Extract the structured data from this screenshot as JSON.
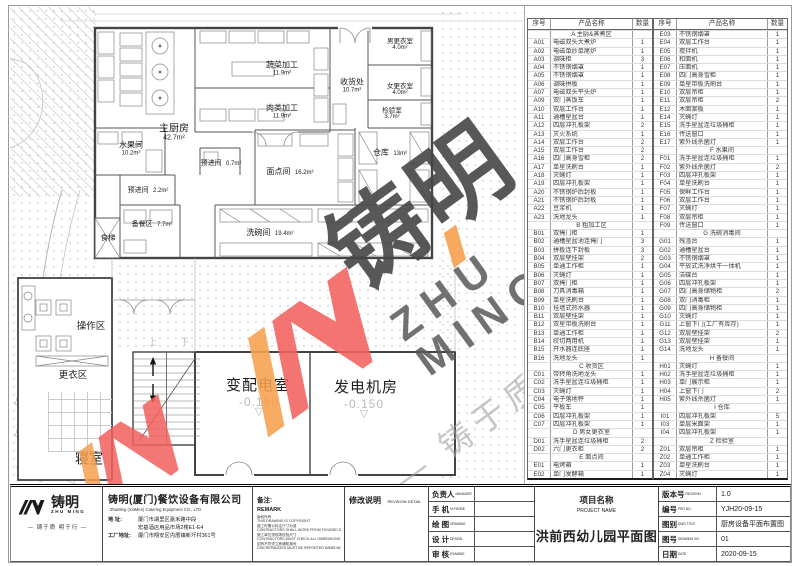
{
  "brand_colors": {
    "coral": "#f2615e",
    "orange": "#f6a04e",
    "logo_black": "#1a1a1a"
  },
  "watermark": {
    "brand": "铸明",
    "brand_en": "ZHU MING",
    "tagline": "— 铸于质 明于行 —"
  },
  "plan": {
    "stair_up": "上",
    "stair_down": "下",
    "levels": [
      {
        "value": "-0.150"
      },
      {
        "value": "-0.150"
      }
    ],
    "rooms": [
      {
        "name": "蔬菜加工",
        "area": "11.9m²"
      },
      {
        "name": "肉类加工",
        "area": "11.9m²"
      },
      {
        "name": "收货处",
        "area": "10.7m²"
      },
      {
        "name": "男更衣室",
        "area": "4.0m²"
      },
      {
        "name": "女更衣室",
        "area": "4.0m²"
      },
      {
        "name": "检验室",
        "area": "3.7m²"
      },
      {
        "name": "主厨房",
        "area": "42.7m²"
      },
      {
        "name": "水果间",
        "area": "10.2m²"
      },
      {
        "name": "预进间",
        "area": "2.2m²"
      },
      {
        "name": "预进间",
        "area": "0.7m²"
      },
      {
        "name": "面点间",
        "area": "16.2m²"
      },
      {
        "name": "仓库",
        "area": "13m²"
      },
      {
        "name": "备餐区",
        "area": "7.7m²"
      },
      {
        "name": "洗碗间",
        "area": "19.4m²"
      },
      {
        "name": "食梯",
        "area": ""
      },
      {
        "name": "操作区",
        "area": ""
      },
      {
        "name": "更衣区",
        "area": ""
      },
      {
        "name": "寝室",
        "area": ""
      },
      {
        "name": "变配电室",
        "area": ""
      },
      {
        "name": "发电机房",
        "area": ""
      }
    ]
  },
  "tables": {
    "headers": [
      "序号",
      "产品名称",
      "数量"
    ],
    "left": {
      "rows": [
        {
          "section": true,
          "code": "",
          "name": "A 主厨&蒸煮区",
          "qty": ""
        },
        {
          "code": "A01",
          "name": "电磁双头大煮炉",
          "qty": "1"
        },
        {
          "code": "A02",
          "name": "电磁单炒单尾炉",
          "qty": "1"
        },
        {
          "code": "A03",
          "name": "调味柜",
          "qty": "3"
        },
        {
          "code": "A04",
          "name": "不锈钢烟罩",
          "qty": "1"
        },
        {
          "code": "A05",
          "name": "不锈钢烟罩",
          "qty": "1"
        },
        {
          "code": "A06",
          "name": "调味拼板",
          "qty": "1"
        },
        {
          "code": "A07",
          "name": "电磁双头平头炉",
          "qty": "1"
        },
        {
          "code": "A09",
          "name": "双门蒸饭车",
          "qty": "1"
        },
        {
          "code": "A10",
          "name": "双层工作台",
          "qty": "1"
        },
        {
          "code": "A11",
          "name": "通槽星盆台",
          "qty": "1"
        },
        {
          "code": "A12",
          "name": "四层冲孔板架",
          "qty": "2"
        },
        {
          "code": "A13",
          "name": "灭火系统",
          "qty": "1"
        },
        {
          "code": "A14",
          "name": "双层工作台",
          "qty": "2"
        },
        {
          "code": "A15",
          "name": "双层工作台",
          "qty": "2"
        },
        {
          "code": "A16",
          "name": "四门高身雪柜",
          "qty": "2"
        },
        {
          "code": "A17",
          "name": "单星洗刷台",
          "qty": "1"
        },
        {
          "code": "A18",
          "name": "灭蝇灯",
          "qty": "1"
        },
        {
          "code": "A19",
          "name": "四层冲孔板架",
          "qty": "1"
        },
        {
          "code": "A20",
          "name": "不锈钢炉后封板",
          "qty": "1"
        },
        {
          "code": "A21",
          "name": "不锈钢炉后封板",
          "qty": "1"
        },
        {
          "code": "A22",
          "name": "豆浆机",
          "qty": "1"
        },
        {
          "code": "A23",
          "name": "洗地龙头",
          "qty": "1"
        },
        {
          "section": true,
          "code": "",
          "name": "B 粗加工区",
          "qty": ""
        },
        {
          "code": "B01",
          "name": "双掩门柜",
          "qty": "1"
        },
        {
          "code": "B02",
          "name": "通槽星盆池连掩门",
          "qty": "3"
        },
        {
          "code": "B03",
          "name": "拼板连下封板",
          "qty": "3"
        },
        {
          "code": "B04",
          "name": "双层壁挂架",
          "qty": "2"
        },
        {
          "code": "B05",
          "name": "单通工作柜",
          "qty": "1"
        },
        {
          "code": "B06",
          "name": "灭蝇灯",
          "qty": "1"
        },
        {
          "code": "B07",
          "name": "双掩门柜",
          "qty": "1"
        },
        {
          "code": "B08",
          "name": "刀具消毒箱",
          "qty": "1"
        },
        {
          "code": "B09",
          "name": "单星洗刷台",
          "qty": "1"
        },
        {
          "code": "B10",
          "name": "挂墙式热水器",
          "qty": "1"
        },
        {
          "code": "B11",
          "name": "双层壁挂架",
          "qty": "1"
        },
        {
          "code": "B12",
          "name": "双星带板洗刷台",
          "qty": "1"
        },
        {
          "code": "B13",
          "name": "单通工作柜",
          "qty": "1"
        },
        {
          "code": "B14",
          "name": "绞切两用机",
          "qty": "1"
        },
        {
          "code": "B15",
          "name": "开水器连底座",
          "qty": "1"
        },
        {
          "code": "B16",
          "name": "洗地龙头",
          "qty": "1"
        },
        {
          "section": true,
          "code": "",
          "name": "C 收货区",
          "qty": ""
        },
        {
          "code": "C01",
          "name": "带转角洗地龙头",
          "qty": "1"
        },
        {
          "code": "C02",
          "name": "洗手星盆连垃圾桶柜",
          "qty": "1"
        },
        {
          "code": "C03",
          "name": "灭蝇灯",
          "qty": "1"
        },
        {
          "code": "C04",
          "name": "电子落地秤",
          "qty": "1"
        },
        {
          "code": "C05",
          "name": "平板车",
          "qty": "1"
        },
        {
          "code": "C06",
          "name": "四层冲孔板架",
          "qty": "1"
        },
        {
          "code": "C07",
          "name": "四层冲孔板架",
          "qty": "1"
        },
        {
          "section": true,
          "code": "",
          "name": "D 男女更衣室",
          "qty": ""
        },
        {
          "code": "D01",
          "name": "洗手星盆连垃圾桶柜",
          "qty": "2"
        },
        {
          "code": "D02",
          "name": "六门更衣柜",
          "qty": "2"
        },
        {
          "section": true,
          "code": "",
          "name": "E 面点间",
          "qty": ""
        },
        {
          "code": "E01",
          "name": "电烤箱",
          "qty": "1"
        },
        {
          "code": "E02",
          "name": "单门发酵箱",
          "qty": "1"
        }
      ]
    },
    "right": {
      "rows": [
        {
          "code": "E03",
          "name": "不锈钢烟罩",
          "qty": "1"
        },
        {
          "code": "E04",
          "name": "双层工作台",
          "qty": "1"
        },
        {
          "code": "E05",
          "name": "搅拌机",
          "qty": "1"
        },
        {
          "code": "E06",
          "name": "和面机",
          "qty": "1"
        },
        {
          "code": "E07",
          "name": "压面机",
          "qty": "1"
        },
        {
          "code": "E08",
          "name": "四门高身雪柜",
          "qty": "1"
        },
        {
          "code": "E09",
          "name": "单星带板洗刷台",
          "qty": "1"
        },
        {
          "code": "E10",
          "name": "双层吊柜",
          "qty": "1"
        },
        {
          "code": "E11",
          "name": "双层吊柜",
          "qty": "2"
        },
        {
          "code": "E12",
          "name": "木面案板",
          "qty": "1"
        },
        {
          "code": "E14",
          "name": "灭蝇灯",
          "qty": "1"
        },
        {
          "code": "E15",
          "name": "洗手星盆连垃圾桶柜",
          "qty": "1"
        },
        {
          "code": "E16",
          "name": "传送窗口",
          "qty": "1"
        },
        {
          "code": "E17",
          "name": "紫外线杀菌灯",
          "qty": "1"
        },
        {
          "section": true,
          "code": "",
          "name": "F 水果间",
          "qty": ""
        },
        {
          "code": "F01",
          "name": "洗手星盆连垃圾桶柜",
          "qty": "1"
        },
        {
          "code": "F02",
          "name": "紫外线杀菌灯",
          "qty": "2"
        },
        {
          "code": "F03",
          "name": "四层冲孔板架",
          "qty": "1"
        },
        {
          "code": "F04",
          "name": "单星洗刷台",
          "qty": "1"
        },
        {
          "code": "F05",
          "name": "保鲜工作台",
          "qty": "1"
        },
        {
          "code": "F06",
          "name": "双层工作台",
          "qty": "1"
        },
        {
          "code": "F07",
          "name": "灭蝇灯",
          "qty": "1"
        },
        {
          "code": "F08",
          "name": "双层吊柜",
          "qty": "1"
        },
        {
          "code": "F09",
          "name": "传送窗口",
          "qty": "1"
        },
        {
          "section": true,
          "code": "",
          "name": "G 洗碗消毒间",
          "qty": ""
        },
        {
          "code": "G01",
          "name": "残渣台",
          "qty": "1"
        },
        {
          "code": "G02",
          "name": "通槽星盆台",
          "qty": "1"
        },
        {
          "code": "G03",
          "name": "不锈钢烟罩",
          "qty": "1"
        },
        {
          "code": "G04",
          "name": "平放式洗净烘干一体机",
          "qty": "1"
        },
        {
          "code": "G05",
          "name": "洁碟台",
          "qty": "1"
        },
        {
          "code": "G06",
          "name": "四层冲孔板架",
          "qty": "1"
        },
        {
          "code": "G07",
          "name": "四门高身储物柜",
          "qty": "2"
        },
        {
          "code": "G08",
          "name": "双门消毒柜",
          "qty": "1"
        },
        {
          "code": "G09",
          "name": "四门高身储物柜",
          "qty": "1"
        },
        {
          "code": "G10",
          "name": "灭蝇灯",
          "qty": "1"
        },
        {
          "code": "G11",
          "name": "上窗下门(工厂有库存)",
          "qty": "1"
        },
        {
          "code": "G12",
          "name": "双层壁挂架",
          "qty": "2"
        },
        {
          "code": "G13",
          "name": "双层壁挂架",
          "qty": "1"
        },
        {
          "code": "G14",
          "name": "洗地龙头",
          "qty": "1"
        },
        {
          "section": true,
          "code": "",
          "name": "H 备餐间",
          "qty": ""
        },
        {
          "code": "H01",
          "name": "灭蝇灯",
          "qty": "1"
        },
        {
          "code": "H02",
          "name": "洗手星盆连垃圾桶柜",
          "qty": "1"
        },
        {
          "code": "H03",
          "name": "单门展示柜",
          "qty": "1"
        },
        {
          "code": "H04",
          "name": "上窗下门",
          "qty": "2"
        },
        {
          "code": "H05",
          "name": "紫外线杀菌灯",
          "qty": "1"
        },
        {
          "section": true,
          "code": "",
          "name": "I 仓库",
          "qty": ""
        },
        {
          "code": "I01",
          "name": "四层冲孔板架",
          "qty": "5"
        },
        {
          "code": "I03",
          "name": "单层米面架",
          "qty": "1"
        },
        {
          "code": "I04",
          "name": "四层冲孔板架",
          "qty": "1"
        },
        {
          "section": true,
          "code": "",
          "name": "Z 检验室",
          "qty": ""
        },
        {
          "code": "Z01",
          "name": "双层吊柜",
          "qty": "1"
        },
        {
          "code": "Z02",
          "name": "单通工作柜",
          "qty": "1"
        },
        {
          "code": "Z03",
          "name": "单星洗刷台",
          "qty": "1"
        },
        {
          "code": "Z04",
          "name": "灭蝇灯",
          "qty": "1"
        }
      ]
    }
  },
  "titleblock": {
    "logo": {
      "brand": "铸明",
      "brand_en": "ZHU MING",
      "tagline": "— 铸于质 明于行 —"
    },
    "company": {
      "name": "铸明(厦门)餐饮设备有限公司",
      "name_en": "ZhuMing (XiaMen) Catering Equipment CO., LTD",
      "addr_label": "地  址:",
      "addr": "厦门市湖里区嘉禾路中段\n宏基酒店用品市场2楼E1-E4",
      "factory_label": "工厂地址:",
      "factory": "厦门市翔安区内厝镇新圩村361号"
    },
    "remark": {
      "label": "备注:",
      "label_en": "REMARK",
      "lines": [
        "版权所有",
        "THIS DRAWING IS COPYRIGHT",
        "施工时需以标注尺寸为准",
        "CONTRACTORS SHALL WORK FROM FIGURED DIMENSIONS ONLY",
        "施工单位须现场校验尺寸",
        "CONTRACTORS MUST CHECK ALL DIMENSIONS ON SITE",
        "如有不符须立即通知我司",
        "DISCREPANCIES MUST BE REPORTED IMMEDIATELY TO ARCHITECTS"
      ]
    },
    "revision_detail": {
      "label": "修改说明",
      "label_en": "REVISION DETAIL"
    },
    "roles": [
      {
        "label": "负责人",
        "en": "MANAGER"
      },
      {
        "label": "手  机",
        "en": "M.PHONE"
      },
      {
        "label": "绘  图",
        "en": "DRAWING"
      },
      {
        "label": "设  计",
        "en": "DESIGN"
      },
      {
        "label": "审  核",
        "en": "EXAMINE"
      }
    ],
    "project": {
      "label": "项目名称",
      "label_en": "PROJECT NAME",
      "name": "洪前西幼儿园平面图"
    },
    "info": [
      {
        "label": "版本号",
        "en": "REVISION",
        "value": "1.0"
      },
      {
        "label": "编号",
        "en": "PRO NO.",
        "value": "YJH20-09-15"
      },
      {
        "label": "图别",
        "en": "DWG.TITLE",
        "value": "厨房设备平面布置图"
      },
      {
        "label": "图号",
        "en": "DRAWING NO.",
        "value": "01"
      },
      {
        "label": "日期",
        "en": "DATE",
        "value": "2020-09-15"
      }
    ]
  }
}
